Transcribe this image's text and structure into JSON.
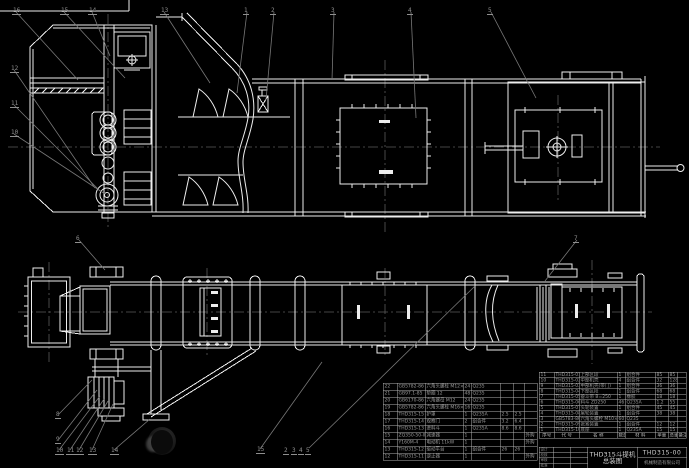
{
  "drawing": {
    "title": "THD315斗提机",
    "subtitle": "总装图",
    "code": "THD315-00",
    "company": "机械制造有限公司"
  },
  "bom": {
    "header": [
      "序号",
      "代  号",
      "名  称",
      "数量",
      "材  料",
      "单重",
      "总重",
      "备注"
    ],
    "left_rows": [
      [
        "22",
        "GB5782-86",
        "六角头螺栓 M12×40",
        "24",
        "Q235",
        "",
        "",
        ""
      ],
      [
        "21",
        "GB97.1-85",
        "垫圈 12",
        "48",
        "Q235",
        "",
        "",
        ""
      ],
      [
        "20",
        "GB6170-86",
        "六角螺母 M12",
        "24",
        "Q235",
        "",
        "",
        ""
      ],
      [
        "19",
        "GB5782-86",
        "六角头螺栓 M16×55",
        "16",
        "Q235",
        "",
        "",
        ""
      ],
      [
        "18",
        "THD315-15",
        "护罩",
        "1",
        "Q235A",
        "2.5",
        "2.5",
        ""
      ],
      [
        "17",
        "THD315-14",
        "观察门",
        "2",
        "组合件",
        "3.2",
        "6.4",
        ""
      ],
      [
        "16",
        "THD315-13",
        "进料斗",
        "1",
        "Q235A",
        "8.6",
        "8.6",
        ""
      ],
      [
        "15",
        "ZQ350-50-Ⅱ",
        "减速器",
        "1",
        "",
        "",
        "",
        "外购"
      ],
      [
        "14",
        "Y160M-4",
        "电动机 11kW",
        "1",
        "",
        "",
        "",
        "外购"
      ],
      [
        "13",
        "THD315-12",
        "驱动平台",
        "1",
        "组合件",
        "26",
        "26",
        ""
      ],
      [
        "12",
        "THD315-11",
        "逆止器",
        "1",
        "",
        "",
        "",
        "外购"
      ]
    ],
    "right_rows": [
      [
        "11",
        "THD315-01",
        "上部区段",
        "1",
        "组合件",
        "85",
        "85",
        ""
      ],
      [
        "10",
        "THD315-02",
        "中部机壳",
        "4",
        "组合件",
        "32",
        "128",
        ""
      ],
      [
        "9",
        "THD315-03",
        "中部机壳(带门)",
        "1",
        "组合件",
        "36",
        "36",
        ""
      ],
      [
        "8",
        "THD315-04",
        "下部区段",
        "1",
        "组合件",
        "68",
        "68",
        ""
      ],
      [
        "7",
        "THD315-05",
        "畚斗带 B=250",
        "1",
        "橡胶",
        "18",
        "18",
        ""
      ],
      [
        "6",
        "THD315-06",
        "料斗 ZD250",
        "46",
        "Q235A",
        "1.2",
        "55",
        ""
      ],
      [
        "5",
        "THD315-07",
        "头轮装置",
        "1",
        "组合件",
        "45",
        "45",
        ""
      ],
      [
        "4",
        "THD315-08",
        "尾轮装置",
        "1",
        "组合件",
        "38",
        "38",
        ""
      ],
      [
        "3",
        "GB5783-86",
        "六角头螺栓 M10×35",
        "60",
        "Q235",
        "",
        "",
        ""
      ],
      [
        "2",
        "THD315-09",
        "张紧装置",
        "1",
        "组合件",
        "12",
        "12",
        ""
      ],
      [
        "1",
        "THD315-10",
        "底座",
        "1",
        "Q235A",
        "15",
        "15",
        ""
      ]
    ]
  },
  "title_block": {
    "revision_rows": [
      [
        "设计",
        "",
        ""
      ],
      [
        "校核",
        "",
        ""
      ],
      [
        "审核",
        "",
        ""
      ],
      [
        "批准",
        "",
        ""
      ]
    ]
  },
  "callouts": {
    "labels": [
      "16",
      "15",
      "14",
      "13",
      "1",
      "2",
      "3",
      "4",
      "5",
      "12",
      "11",
      "10",
      "6",
      "7",
      "8",
      "9",
      "10",
      "11",
      "12",
      "13",
      "14",
      "15",
      "2",
      "3",
      "4",
      "5"
    ]
  },
  "colors": {
    "background": "#000000",
    "line": "#ededed",
    "leader": "#787878",
    "table_grid": "#b0b0b0",
    "table_text": "#9a9a9a",
    "title_text": "#cfcfcf"
  }
}
